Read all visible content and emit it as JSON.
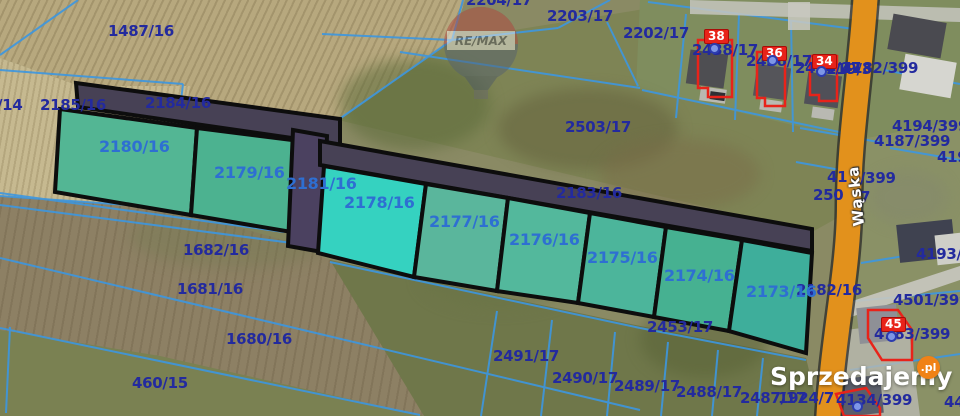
{
  "meta": {
    "width": 960,
    "height": 416,
    "description": "cadastral parcel map with highlighted plots for sale"
  },
  "watermark": {
    "brand": "Sprzedajemy",
    "tld": ".pl",
    "balloon_text": "RE/MAX"
  },
  "street": {
    "name": "Wąska"
  },
  "colors": {
    "highlight_teal": "#4cb295",
    "highlight_bright_teal": "#35d2c0",
    "road_parcel_fill": "#474155",
    "parcel_border": "#0d0d0d",
    "cadastral_line_blue": "#3d97e0",
    "label_navy": "#232a9e",
    "label_blue": "#2e6fd2",
    "road_orange": "#e2911c",
    "marker_red": "#e8231a",
    "marker_dot_blue": "#7e96e6",
    "logo_orange": "#f08216"
  },
  "highlighted_parcel_ids": [
    "2180/16",
    "2179/16",
    "2181/16",
    "2178/16",
    "2177/16",
    "2176/16",
    "2175/16",
    "2174/16",
    "2173/16"
  ],
  "road_parcel_ids": [
    "2184/16",
    "2183/16"
  ],
  "map_labels": [
    {
      "t": "1487/16",
      "x": 108,
      "y": 24,
      "c": "navy"
    },
    {
      "t": "2204/17",
      "x": 466,
      "y": -7,
      "c": "navy"
    },
    {
      "t": "2203/17",
      "x": 547,
      "y": 9,
      "c": "navy"
    },
    {
      "t": "2202/17",
      "x": 623,
      "y": 26,
      "c": "navy"
    },
    {
      "t": "2503/17",
      "x": 565,
      "y": 120,
      "c": "navy"
    },
    {
      "t": "/14",
      "x": -3,
      "y": 98,
      "c": "navy"
    },
    {
      "t": "2185/16",
      "x": 40,
      "y": 98,
      "c": "navy"
    },
    {
      "t": "2184/16",
      "x": 145,
      "y": 96,
      "c": "navy"
    },
    {
      "t": "2183/16",
      "x": 556,
      "y": 186,
      "c": "navy"
    },
    {
      "t": "2182/16",
      "x": 796,
      "y": 283,
      "c": "navy"
    },
    {
      "t": "1682/16",
      "x": 183,
      "y": 243,
      "c": "navy"
    },
    {
      "t": "1681/16",
      "x": 177,
      "y": 282,
      "c": "navy"
    },
    {
      "t": "1680/16",
      "x": 226,
      "y": 332,
      "c": "navy"
    },
    {
      "t": "460/15",
      "x": 132,
      "y": 376,
      "c": "navy"
    },
    {
      "t": "2453/17",
      "x": 647,
      "y": 320,
      "c": "navy"
    },
    {
      "t": "2491/17",
      "x": 493,
      "y": 349,
      "c": "navy"
    },
    {
      "t": "2490/17",
      "x": 552,
      "y": 371,
      "c": "navy"
    },
    {
      "t": "2489/17",
      "x": 614,
      "y": 379,
      "c": "navy"
    },
    {
      "t": "2488/17",
      "x": 676,
      "y": 385,
      "c": "navy"
    },
    {
      "t": "2487/17",
      "x": 740,
      "y": 391,
      "c": "navy"
    },
    {
      "t": "1924/7",
      "x": 778,
      "y": 391,
      "c": "navy"
    },
    {
      "t": "4134/399",
      "x": 836,
      "y": 393,
      "c": "navy"
    },
    {
      "t": "44",
      "x": 944,
      "y": 395,
      "c": "navy"
    },
    {
      "t": "2438/17",
      "x": 692,
      "y": 43,
      "c": "navy"
    },
    {
      "t": "2436/17",
      "x": 746,
      "y": 54,
      "c": "navy"
    },
    {
      "t": "2434/17",
      "x": 795,
      "y": 61,
      "c": "navy"
    },
    {
      "t": "4219/3",
      "x": 816,
      "y": 62,
      "c": "navy"
    },
    {
      "t": "4182/399",
      "x": 842,
      "y": 61,
      "c": "navy"
    },
    {
      "t": "4194/399",
      "x": 892,
      "y": 119,
      "c": "navy"
    },
    {
      "t": "4187/399",
      "x": 874,
      "y": 134,
      "c": "navy"
    },
    {
      "t": "419",
      "x": 937,
      "y": 150,
      "c": "navy"
    },
    {
      "t": "41",
      "x": 827,
      "y": 170,
      "c": "navy"
    },
    {
      "t": "/399",
      "x": 860,
      "y": 171,
      "c": "navy"
    },
    {
      "t": "250",
      "x": 813,
      "y": 188,
      "c": "navy"
    },
    {
      "t": "7",
      "x": 860,
      "y": 190,
      "c": "navy"
    },
    {
      "t": "4193/399",
      "x": 916,
      "y": 247,
      "c": "navy"
    },
    {
      "t": "4501/399",
      "x": 893,
      "y": 293,
      "c": "navy"
    },
    {
      "t": "4183/399",
      "x": 874,
      "y": 327,
      "c": "navy"
    },
    {
      "t": "2180/16",
      "x": 99,
      "y": 139,
      "c": "blue"
    },
    {
      "t": "2179/16",
      "x": 214,
      "y": 165,
      "c": "blue"
    },
    {
      "t": "2181/16",
      "x": 286,
      "y": 176,
      "c": "blue"
    },
    {
      "t": "2178/16",
      "x": 344,
      "y": 195,
      "c": "blue"
    },
    {
      "t": "2177/16",
      "x": 429,
      "y": 214,
      "c": "blue"
    },
    {
      "t": "2176/16",
      "x": 509,
      "y": 232,
      "c": "blue"
    },
    {
      "t": "2175/16",
      "x": 587,
      "y": 250,
      "c": "blue"
    },
    {
      "t": "2174/16",
      "x": 664,
      "y": 268,
      "c": "blue"
    },
    {
      "t": "2173/16",
      "x": 746,
      "y": 284,
      "c": "blue"
    }
  ],
  "house_markers": [
    {
      "n": "38",
      "x": 704,
      "y": 29,
      "dotx": 714,
      "doty": 48
    },
    {
      "n": "36",
      "x": 762,
      "y": 46,
      "dotx": 772,
      "doty": 60
    },
    {
      "n": "34",
      "x": 812,
      "y": 54,
      "dotx": 821,
      "doty": 71
    },
    {
      "n": "45",
      "x": 881,
      "y": 317,
      "dotx": 891,
      "doty": 336
    },
    {
      "n": "",
      "x": 0,
      "y": 0,
      "dotx": 857,
      "doty": 406
    }
  ]
}
